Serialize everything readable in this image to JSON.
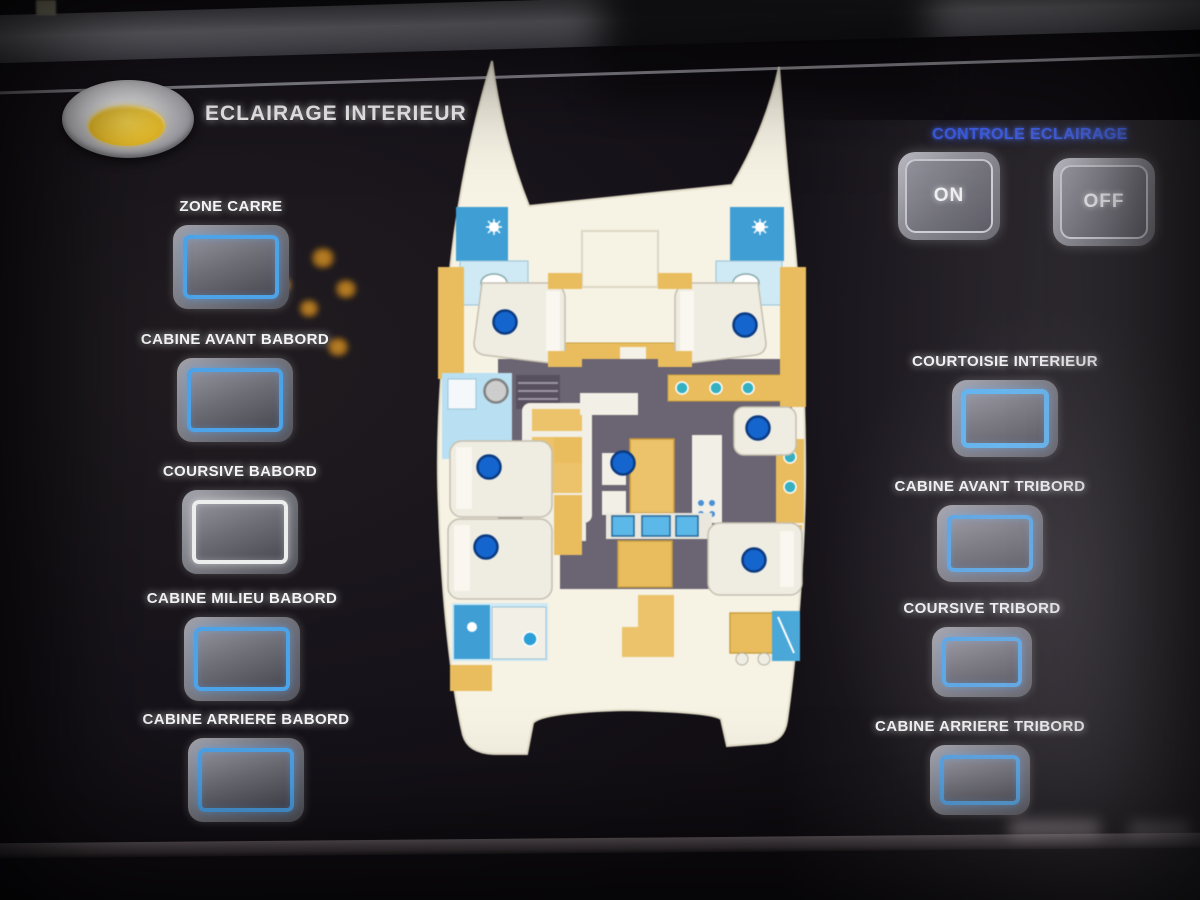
{
  "header": {
    "title": "ECLAIRAGE INTERIEUR",
    "icon": "ceiling-downlight-icon"
  },
  "control_panel": {
    "title": "CONTROLE ECLAIRAGE",
    "title_color": "#2e52e6",
    "on_label": "ON",
    "off_label": "OFF"
  },
  "zones_left": [
    {
      "label": "ZONE CARRE",
      "state": "blue"
    },
    {
      "label": "CABINE AVANT BABORD",
      "state": "blue"
    },
    {
      "label": "COURSIVE BABORD",
      "state": "white"
    },
    {
      "label": "CABINE MILIEU BABORD",
      "state": "blue"
    },
    {
      "label": "CABINE ARRIERE BABORD",
      "state": "blue"
    }
  ],
  "zones_right": [
    {
      "label": "COURTOISIE INTERIEUR",
      "state": "bright"
    },
    {
      "label": "CABINE AVANT TRIBORD",
      "state": "blue"
    },
    {
      "label": "COURSIVE TRIBORD",
      "state": "blue"
    },
    {
      "label": "CABINE ARRIERE TRIBORD",
      "state": "blue"
    }
  ],
  "floorplan": {
    "type": "catamaran-deck-plan",
    "light_on_color": "#1565cf",
    "light_off_color": "#cdcdcd",
    "lights": [
      {
        "zone": "cabine-avant-babord",
        "x": 75,
        "y": 267,
        "state": "on"
      },
      {
        "zone": "cabine-avant-tribord",
        "x": 315,
        "y": 270,
        "state": "on"
      },
      {
        "zone": "coursive-babord",
        "x": 66,
        "y": 336,
        "state": "off"
      },
      {
        "zone": "cabine-milieu-babord",
        "x": 59,
        "y": 412,
        "state": "on"
      },
      {
        "zone": "zone-carre",
        "x": 193,
        "y": 408,
        "state": "on"
      },
      {
        "zone": "coursive-tribord",
        "x": 328,
        "y": 373,
        "state": "on"
      },
      {
        "zone": "cabine-arriere-babord",
        "x": 56,
        "y": 492,
        "state": "on"
      },
      {
        "zone": "cabine-arriere-tribord",
        "x": 324,
        "y": 505,
        "state": "on"
      }
    ]
  }
}
